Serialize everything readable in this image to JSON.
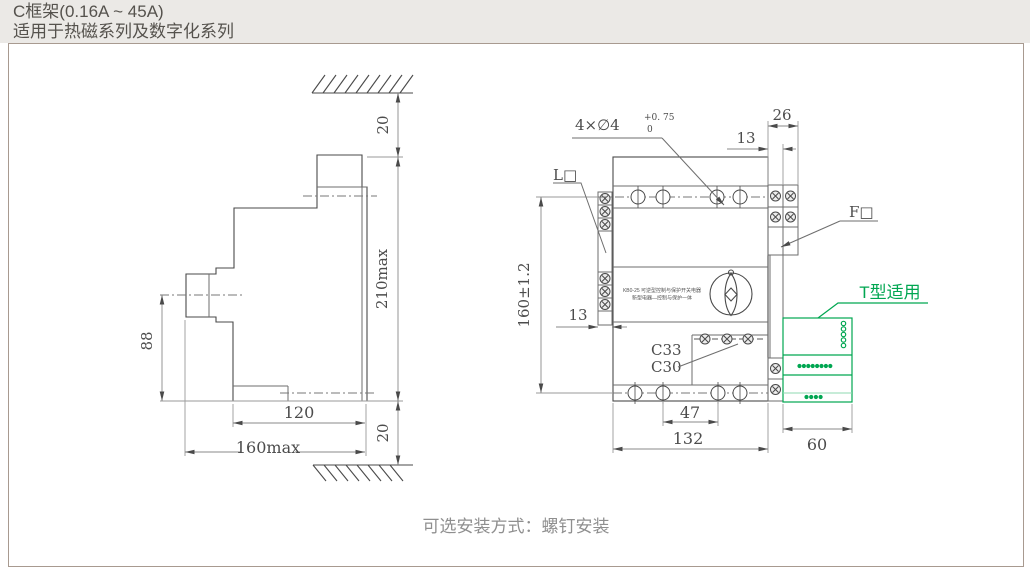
{
  "header": {
    "title": "C框架(0.16A ~ 45A)",
    "subtitle": "适用于热磁系列及数字化系列"
  },
  "footer": {
    "caption": "可选安装方式：螺钉安装"
  },
  "side_view": {
    "dims": {
      "gap_top": "20",
      "height_max": "210max",
      "gap_bottom": "20",
      "center_height": "88",
      "depth_inner": "120",
      "depth_max": "160max"
    }
  },
  "front_view": {
    "dims": {
      "rail_width": "26",
      "rail_offset": "13",
      "strip_offset": "13",
      "height_tol": "160±1.2",
      "hole_pitch": "47",
      "body_width": "132",
      "accessory_width": "60"
    },
    "labels": {
      "mounting_holes": "4×∅4",
      "holes_tol_upper": "+0. 75",
      "holes_tol_lower": "0",
      "line_side": "L□",
      "load_side": "F□",
      "frame_c33": "C33",
      "frame_c30": "C30",
      "accessory_note": "T型适用",
      "product_line1": "KB0-25 可逆型控制与保护开关电器",
      "product_line2": "新型电器—控制与保护一体"
    }
  },
  "colors": {
    "accent_green": "#00A651",
    "line_dark": "#4a4a4a",
    "line_gray": "#9a9a9a",
    "header_bg": "#ebe9e6",
    "border": "#a89a90"
  }
}
